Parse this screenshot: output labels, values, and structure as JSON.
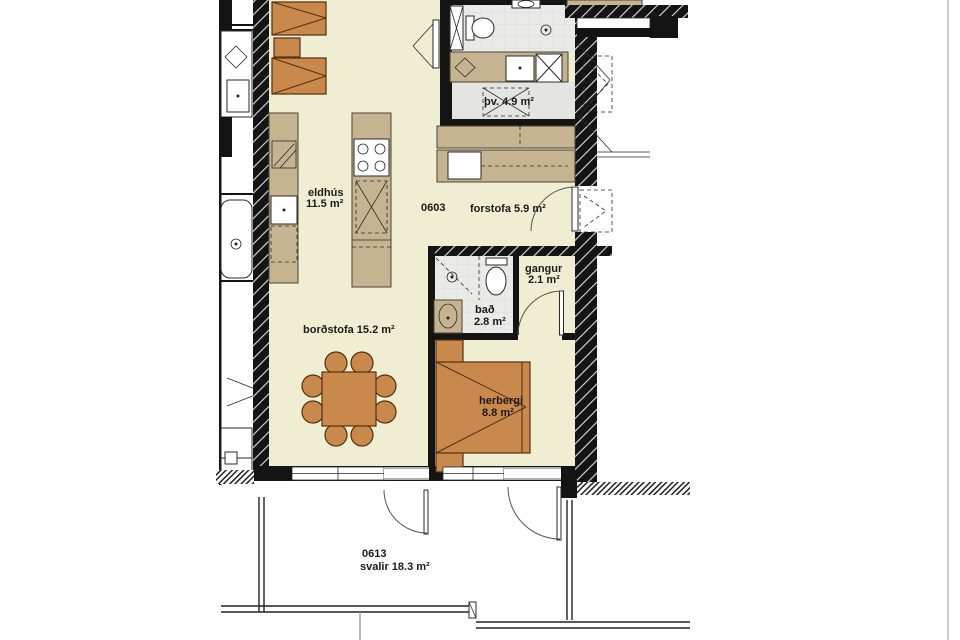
{
  "plan": {
    "unit_number": "0603",
    "rooms": {
      "eldhus": {
        "name": "eldhús",
        "area": "11.5 m²"
      },
      "forstofa": {
        "label": "forstofa 5.9 m²"
      },
      "pv": {
        "label": "þv. 4.9 m²"
      },
      "gangur": {
        "name": "gangur",
        "area": "2.1 m²"
      },
      "bad": {
        "name": "bað",
        "area": "2.8 m²"
      },
      "bordstofa": {
        "label": "borðstofa 15.2 m²"
      },
      "herbergi": {
        "name": "herbergi",
        "area": "8.8 m²"
      },
      "svalir": {
        "number": "0613",
        "label": "svalir 18.3 m²"
      }
    },
    "colors": {
      "floor_cream": "#f0eed2",
      "counter_tan": "#c6b490",
      "furniture_brown": "#c9894d",
      "furniture_border": "#53300e",
      "tile_gray": "#eaeae8",
      "wall_black": "#141414"
    }
  }
}
